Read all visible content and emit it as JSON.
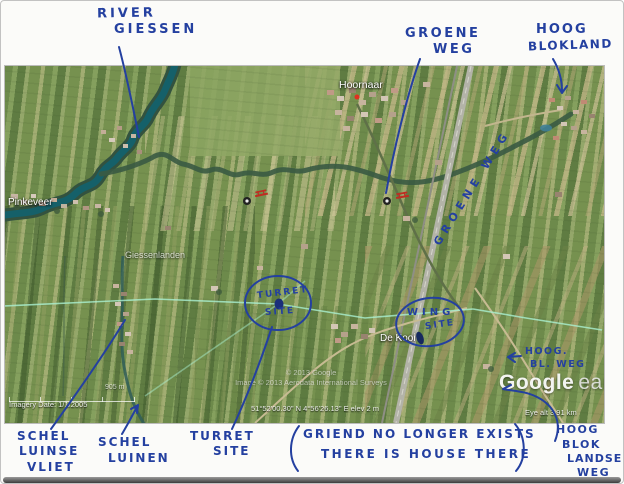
{
  "page": {
    "background": "#fbfbf9",
    "border_color": "#c2c2c2"
  },
  "ink": {
    "color": "#2440a0"
  },
  "annotations": {
    "river_giessen": {
      "l1": "RIVER",
      "l2": "GIESSEN"
    },
    "groene_weg": {
      "l1": "GROENE",
      "l2": "WEG"
    },
    "hoog_blokland": {
      "l1": "HOOG",
      "l2": "BLOKLAND"
    },
    "groene_weg_road": "GROENE WEG",
    "turret_circle": {
      "l1": "TURRET",
      "l2": "SITE"
    },
    "wing_circle": {
      "l1": "WING",
      "l2": "SITE"
    },
    "hoog_bl_weg": {
      "l1": "HOOG.",
      "l2": "BL. WEG"
    },
    "schel_luinse_vliet": {
      "l1": "SCHEL",
      "l2": "LUINSE",
      "l3": "VLIET"
    },
    "schel_luinen": {
      "l1": "SCHEL",
      "l2": "LUINEN"
    },
    "turret_site": {
      "l1": "TURRET",
      "l2": "SITE"
    },
    "note": {
      "l1": "GRIEND NO LONGER EXISTS",
      "l2": "THERE IS HOUSE THERE"
    },
    "hoog_blok_landse_weg": {
      "l1": "HOOG",
      "l2": "BLOK",
      "l3": "LANDSE",
      "l4": "WEG"
    }
  },
  "map": {
    "place_labels": {
      "pinkeveer": "Pinkeveer",
      "hoornaar": "Hoornaar",
      "giessenlanden": "Giessenlanden",
      "de_kooi": "De Kooi"
    },
    "watermarks": {
      "line1": "© 2013 Google",
      "line2": "Image © 2013 Aerodata International Surveys",
      "logo_word1": "Google",
      "logo_word2": "earth"
    },
    "statusbar": {
      "imagery_date": "Imagery Date: 1/1/2005",
      "coordinates": "51°52'00.30\" N    4°56'26.13\" E    elev    2 m",
      "eye_alt": "Eye alt   3.91 km",
      "scale": "905 m"
    }
  }
}
